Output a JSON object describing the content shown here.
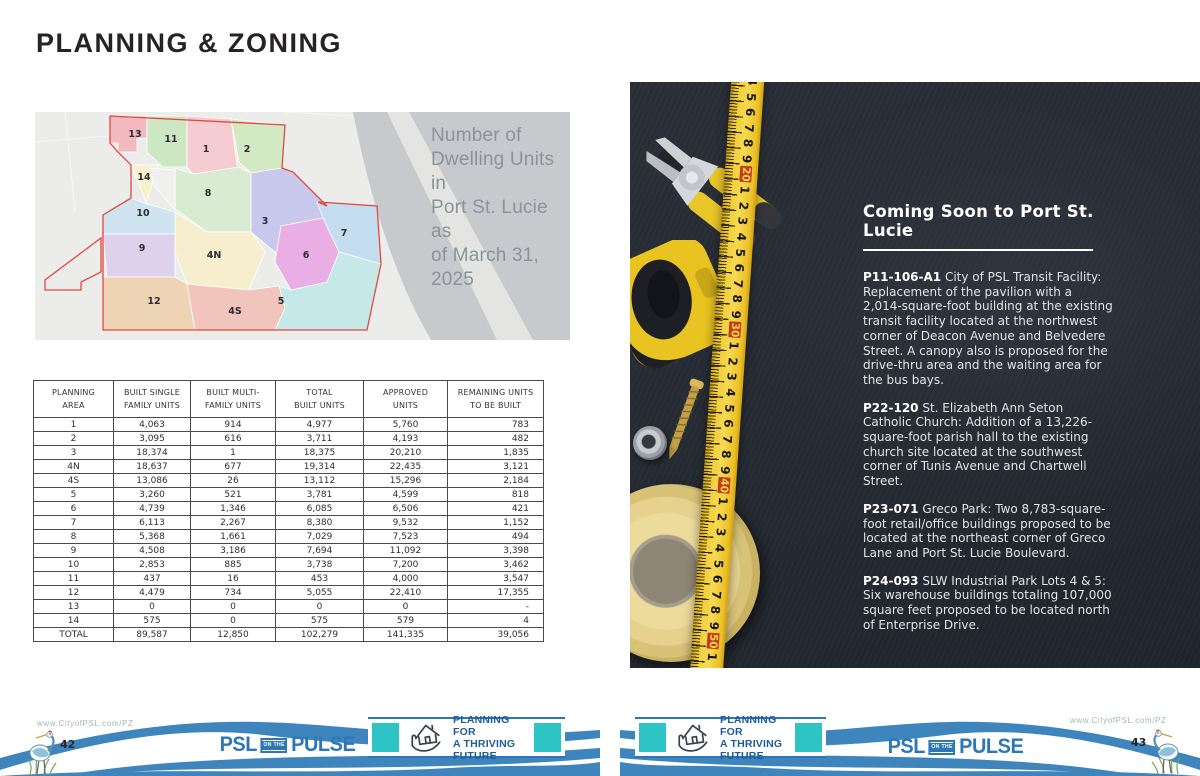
{
  "page_left": {
    "title": "PLANNING & ZONING",
    "map": {
      "caption_lines": [
        "Number of",
        "Dwelling Units in",
        "Port St. Lucie as",
        "of March 31, 2025"
      ],
      "boundary_color": "#e2483d",
      "areas": [
        {
          "label": "13",
          "color": "#f2b9c0",
          "x": 100,
          "y": 25
        },
        {
          "label": "11",
          "color": "#cbe8c3",
          "x": 136,
          "y": 30
        },
        {
          "label": "1",
          "color": "#f6ccd3",
          "x": 171,
          "y": 40
        },
        {
          "label": "2",
          "color": "#d3e9c4",
          "x": 212,
          "y": 40
        },
        {
          "label": "14",
          "color": "#f7f2cd",
          "x": 109,
          "y": 68
        },
        {
          "label": "8",
          "color": "#d9ecd1",
          "x": 173,
          "y": 84
        },
        {
          "label": "10",
          "color": "#cfe3f0",
          "x": 108,
          "y": 104
        },
        {
          "label": "3",
          "color": "#c8c9ec",
          "x": 230,
          "y": 112
        },
        {
          "label": "9",
          "color": "#ddd1ec",
          "x": 107,
          "y": 139
        },
        {
          "label": "4N",
          "color": "#f6eecd",
          "x": 179,
          "y": 146
        },
        {
          "label": "6",
          "color": "#e9aee4",
          "x": 271,
          "y": 146
        },
        {
          "label": "7",
          "color": "#c5ddf1",
          "x": 309,
          "y": 124
        },
        {
          "label": "12",
          "color": "#ecd4b4",
          "x": 119,
          "y": 192
        },
        {
          "label": "4S",
          "color": "#f1c4bc",
          "x": 200,
          "y": 202
        },
        {
          "label": "5",
          "color": "#c5e8e8",
          "x": 246,
          "y": 192
        }
      ]
    },
    "table": {
      "headers": [
        [
          "PLANNING",
          "AREA"
        ],
        [
          "BUILT SINGLE",
          "FAMILY UNITS"
        ],
        [
          "BUILT MULTI-",
          "FAMILY UNITS"
        ],
        [
          "TOTAL",
          "BUILT UNITS"
        ],
        [
          "APPROVED",
          "UNITS"
        ],
        [
          "REMAINING UNITS",
          "TO BE BUILT"
        ]
      ],
      "rows": [
        [
          "1",
          "4,063",
          "914",
          "4,977",
          "5,760",
          "783"
        ],
        [
          "2",
          "3,095",
          "616",
          "3,711",
          "4,193",
          "482"
        ],
        [
          "3",
          "18,374",
          "1",
          "18,375",
          "20,210",
          "1,835"
        ],
        [
          "4N",
          "18,637",
          "677",
          "19,314",
          "22,435",
          "3,121"
        ],
        [
          "4S",
          "13,086",
          "26",
          "13,112",
          "15,296",
          "2,184"
        ],
        [
          "5",
          "3,260",
          "521",
          "3,781",
          "4,599",
          "818"
        ],
        [
          "6",
          "4,739",
          "1,346",
          "6,085",
          "6,506",
          "421"
        ],
        [
          "7",
          "6,113",
          "2,267",
          "8,380",
          "9,532",
          "1,152"
        ],
        [
          "8",
          "5,368",
          "1,661",
          "7,029",
          "7,523",
          "494"
        ],
        [
          "9",
          "4,508",
          "3,186",
          "7,694",
          "11,092",
          "3,398"
        ],
        [
          "10",
          "2,853",
          "885",
          "3,738",
          "7,200",
          "3,462"
        ],
        [
          "11",
          "437",
          "16",
          "453",
          "4,000",
          "3,547"
        ],
        [
          "12",
          "4,479",
          "734",
          "5,055",
          "22,410",
          "17,355"
        ],
        [
          "13",
          "0",
          "0",
          "0",
          "0",
          "-"
        ],
        [
          "14",
          "575",
          "0",
          "575",
          "579",
          "4"
        ]
      ],
      "total_row": [
        "TOTAL",
        "89,587",
        "12,850",
        "102,279",
        "141,335",
        "39,056"
      ]
    }
  },
  "page_right": {
    "heading": "Coming Soon to Port St. Lucie",
    "projects": [
      {
        "code": "P11-106-A1",
        "text": "City of PSL Transit Facility: Replacement of the pavilion with a 2,014-square-foot building at the existing transit facility located at the northwest corner of Deacon Avenue and Belvedere Street. A canopy also is proposed for the drive-thru area and the waiting area for the bus bays."
      },
      {
        "code": "P22-120",
        "text": "St. Elizabeth Ann Seton Catholic Church: Addition of a 13,226-square-foot parish hall to the existing church site located at the southwest corner of Tunis Avenue and Chartwell Street."
      },
      {
        "code": "P23-071",
        "text": "Greco Park: Two 8,783-square-foot retail/office buildings proposed to be located at the northeast corner of Greco Lane and Port St. Lucie Boulevard."
      },
      {
        "code": "P24-093",
        "text": "SLW Industrial Park Lots 4 & 5: Six warehouse buildings totaling 107,000 square feet proposed to be located north of Enterprise Drive."
      }
    ],
    "measuring_tape": {
      "numbers": [
        "4",
        "5",
        "6",
        "7",
        "8",
        "9",
        "20",
        "1",
        "2",
        "3",
        "4",
        "5",
        "6",
        "7",
        "8",
        "9",
        "30",
        "1",
        "2",
        "3",
        "4",
        "5",
        "6",
        "7",
        "8",
        "9",
        "40",
        "1",
        "2",
        "3",
        "4",
        "5",
        "6",
        "7",
        "8",
        "9",
        "50",
        "1"
      ],
      "tape_color": "#f0cb35",
      "decade_box_color": "#c23a1f"
    },
    "photo_objects": [
      "pliers",
      "tape-measure-case",
      "screw",
      "washer",
      "masking-tape-roll",
      "measuring-tape"
    ]
  },
  "footer": {
    "url_left": "www.CityofPSL.com/PZ",
    "url_right": "www.CityofPSL.com/PZ",
    "page_left": "42",
    "page_right": "43",
    "logo": {
      "psl": "PSL",
      "onthe": "ON THE",
      "pulse": "PULSE"
    },
    "badge": {
      "line1": "PLANNING FOR",
      "line2": "A THRIVING",
      "line3": "FUTURE"
    },
    "colors": {
      "wave_blue": "#3d85bc",
      "logo_blue": "#2e77b6",
      "badge_teal": "#2ec4c6",
      "badge_navy": "#1f5c97"
    }
  }
}
